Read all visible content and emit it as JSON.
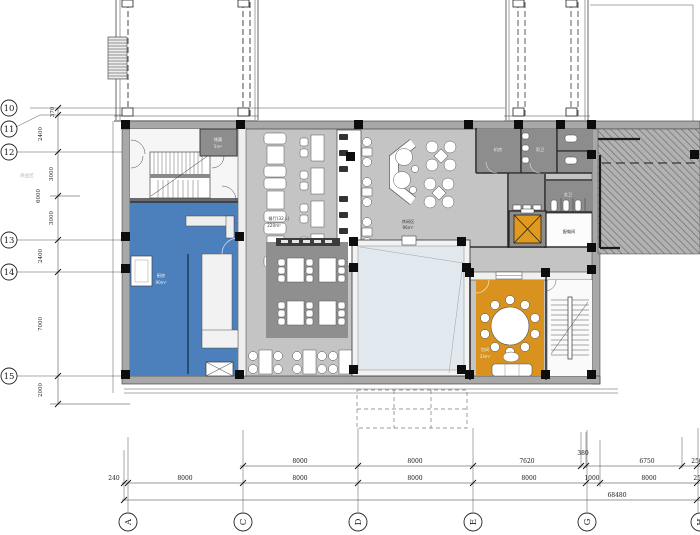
{
  "title": "first-floor-restaurant-plan",
  "grid": {
    "rows": [
      "10",
      "11",
      "12",
      "13",
      "14",
      "15"
    ],
    "cols": [
      "A",
      "C",
      "D",
      "E",
      "G",
      "H"
    ]
  },
  "dims": {
    "left": {
      "v1": "370",
      "v2": "2400",
      "v3": "6000",
      "v4": "2400",
      "v5": "7000",
      "v6": "2000",
      "sub1": "3000",
      "sub2": "3000"
    },
    "upper": [
      "8000",
      "8000",
      "7620",
      "380",
      "6750",
      "250"
    ],
    "lower": [
      "240",
      "8000",
      "8000",
      "8000",
      "8000",
      "1000",
      "8000",
      "2500"
    ],
    "total": "68480"
  },
  "rooms": {
    "dining": {
      "name": "餐厅(32人)",
      "area": "220m²"
    },
    "lounge": {
      "name": "休闲区",
      "area": "96m²"
    },
    "kitchen": {
      "name": "厨房",
      "area": "90m²"
    },
    "private": {
      "name": "包间",
      "area": "33m²"
    },
    "storage": {
      "name": "储藏",
      "area": "5m²"
    },
    "machine_room": "机房",
    "male_wc": "男卫",
    "female_wc": "女卫",
    "power_room": "配电间",
    "zone_note": "商业区"
  },
  "colors": {
    "kitchen_blue": "#4c80bd",
    "private_orange": "#d8921d",
    "elevator_orange": "#e09a20",
    "floor_gray": "#c4c4c4",
    "dark_room_gray": "#8d8d8d",
    "multipurpose_fill": "#e1e8ee",
    "carpet_gray": "#8f8f8f"
  }
}
